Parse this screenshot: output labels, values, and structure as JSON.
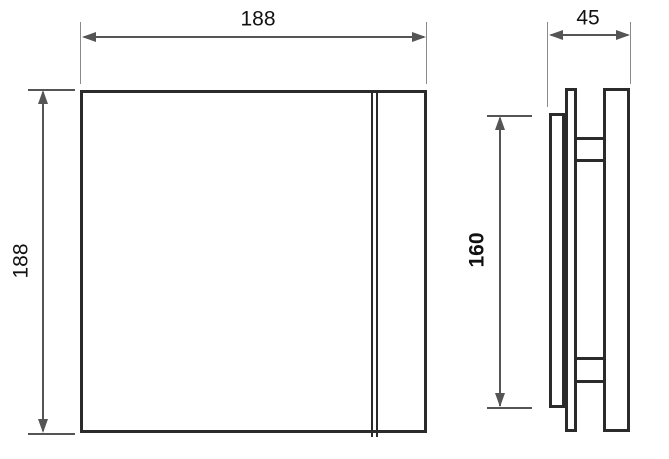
{
  "colors": {
    "background": "#ffffff",
    "outline": "#2b2b2b",
    "dimension_line": "#555555",
    "extension_line": "#8a8a8a",
    "text": "#111111"
  },
  "front_view": {
    "name": "front view of square fan panel",
    "width_dim": "188",
    "height_dim": "188"
  },
  "side_view": {
    "name": "side profile view of fan",
    "depth_dim": "45",
    "height_dim": "160"
  }
}
